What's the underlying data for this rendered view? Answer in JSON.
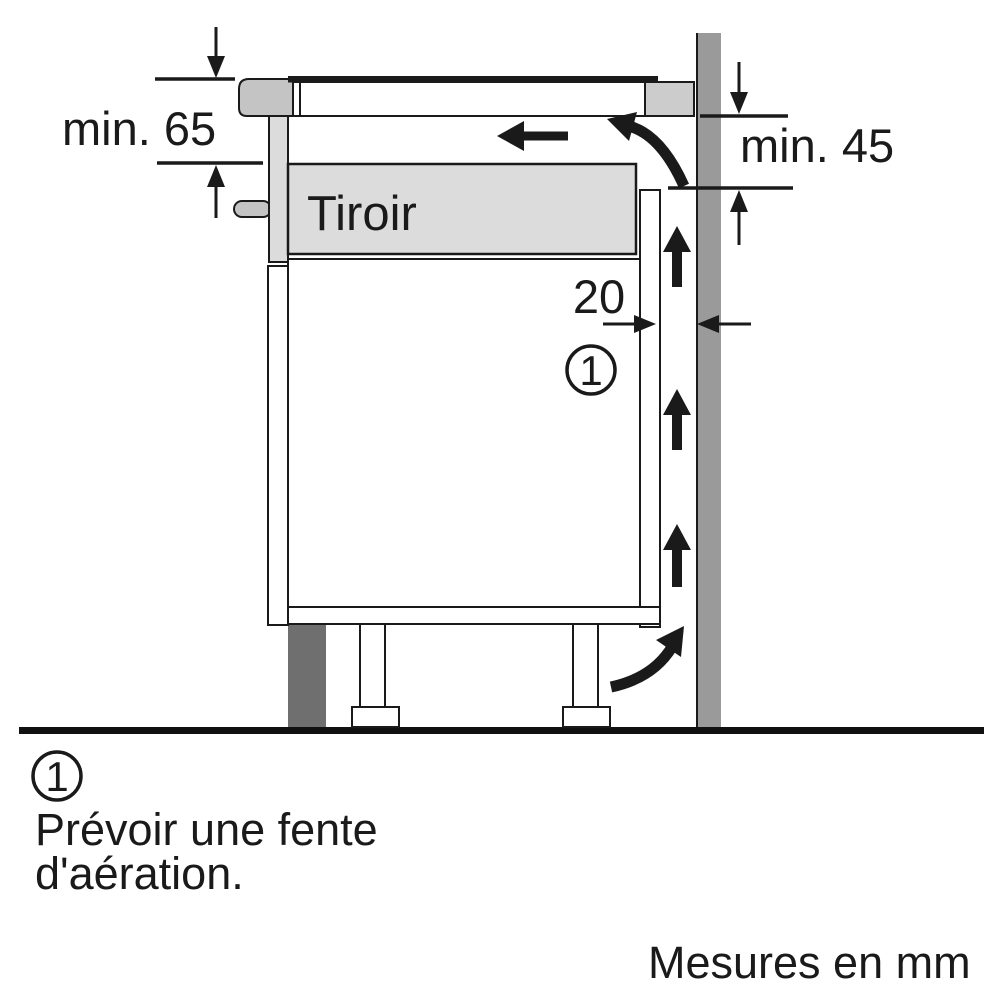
{
  "diagram": {
    "labels": {
      "clearance_top": "min. 65",
      "clearance_right": "min. 45",
      "gap_width": "20",
      "drawer": "Tiroir",
      "callout_marker": "1"
    },
    "colors": {
      "wall": "#9a9a9a",
      "plinth": "#6f6f6f",
      "drawer_front": "#dcdcdc",
      "drawer_box": "#dcdcdc",
      "trim_gray": "#c4c4c4",
      "worktop_gray": "#cccccc",
      "ink": "#1a1a1a"
    }
  },
  "footnote": {
    "marker": "1",
    "line1": "Prévoir une fente",
    "line2": "d'aération."
  },
  "units_note": "Mesures en mm"
}
